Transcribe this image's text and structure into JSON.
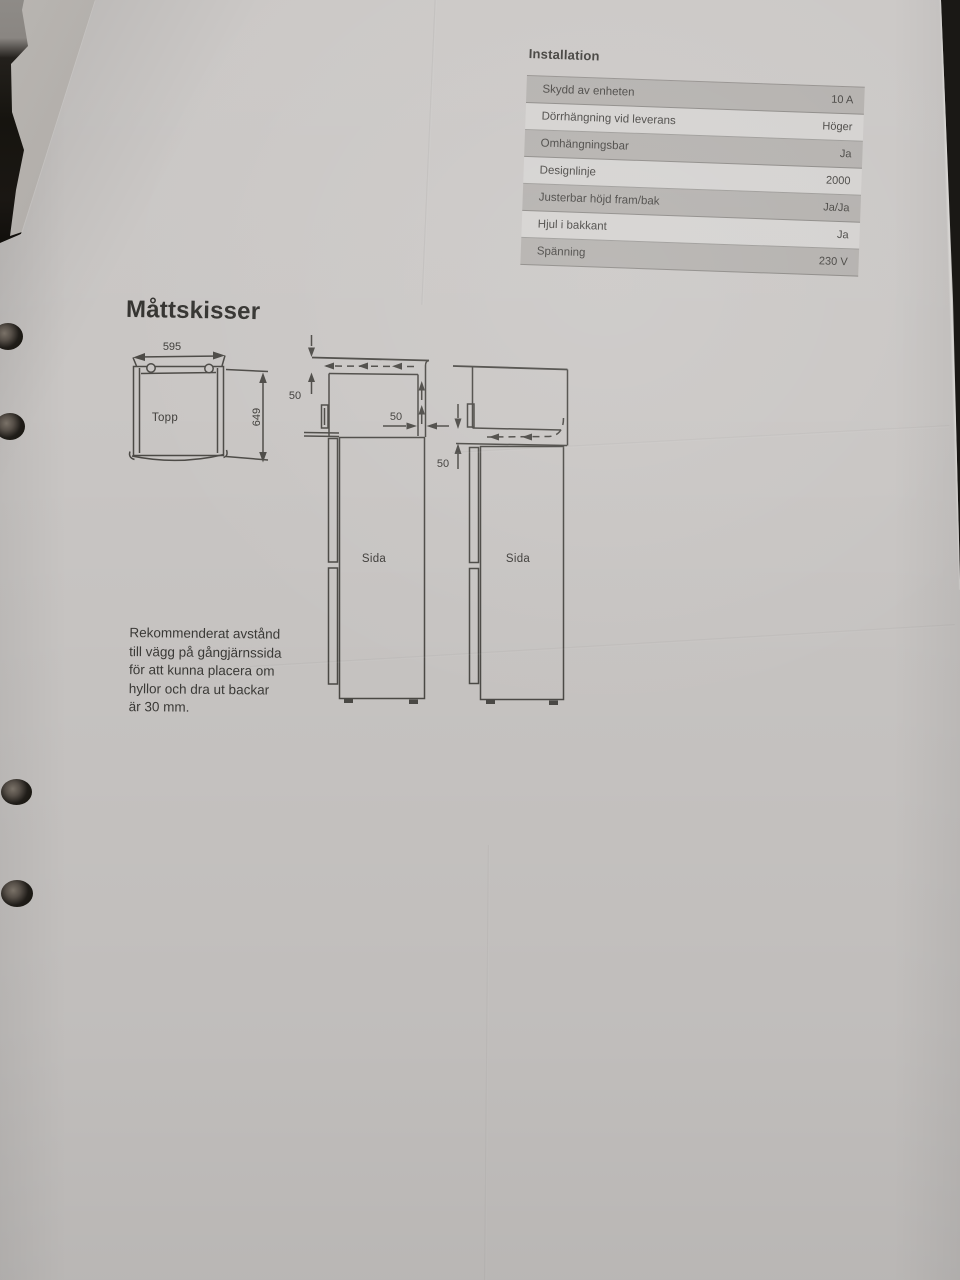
{
  "document": {
    "type": "photographed-spec-sheet",
    "language": "sv"
  },
  "installation_table": {
    "title": "Installation",
    "rows": [
      {
        "label": "Skydd av enheten",
        "value": "10 A"
      },
      {
        "label": "Dörrhängning vid leverans",
        "value": "Höger"
      },
      {
        "label": "Omhängningsbar",
        "value": "Ja"
      },
      {
        "label": "Designlinje",
        "value": "2000"
      },
      {
        "label": "Justerbar höjd fram/bak",
        "value": "Ja/Ja"
      },
      {
        "label": "Hjul i bakkant",
        "value": "Ja"
      },
      {
        "label": "Spänning",
        "value": "230 V"
      }
    ]
  },
  "sketches": {
    "heading": "Måttskisser",
    "top_view": {
      "label": "Topp",
      "width_dim": "595",
      "depth_dim": "649"
    },
    "side_view_1": {
      "label": "Sida",
      "top_clearance": "50",
      "rear_clearance": "50"
    },
    "side_view_2": {
      "label": "Sida",
      "top_clearance": "50"
    },
    "note_lines": [
      "Rekommenderat avstånd",
      "till vägg på gångjärnssida",
      "för att kunna placera om",
      "hyllor och dra ut backar",
      "är 30 mm."
    ]
  },
  "colors": {
    "paper": "#c9c6c4",
    "table_band": "#b8b4b1",
    "ink": "#4b4945",
    "carpet": "#2c2722"
  }
}
